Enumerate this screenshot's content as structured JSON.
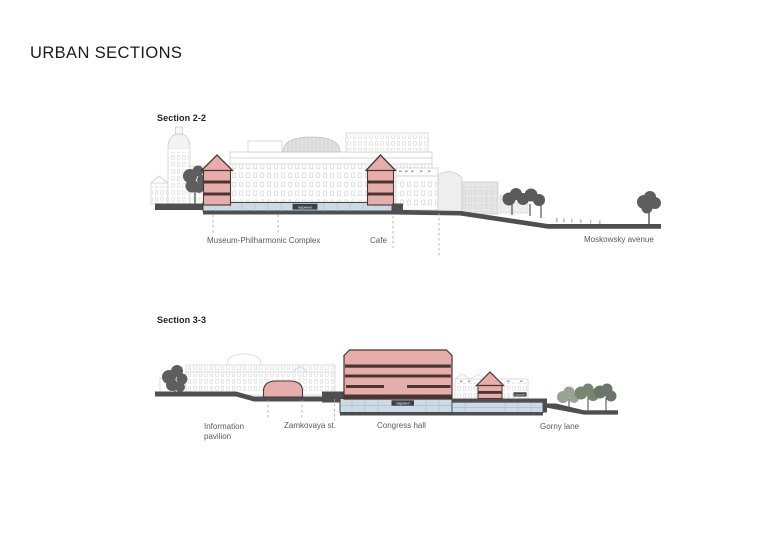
{
  "page": {
    "title": "URBAN SECTIONS"
  },
  "colors": {
    "section_fill": "#e6aeaa",
    "section_outline": "#4a3533",
    "parking_fill": "#ccdae5",
    "ground": "#4f4f4f",
    "context_line": "#c9c9c9",
    "tree_dark": "#5e5e5e",
    "tree_green": "#8f9a88",
    "annotation_text": "#5a5a5a"
  },
  "sections": [
    {
      "label": "Section 2-2",
      "parking_label": "паркинг",
      "annotations": [
        "Museum-Philharmonic Complex",
        "Cafe",
        "Moskowsky avenue"
      ]
    },
    {
      "label": "Section 3-3",
      "parking_label": "паркинг",
      "annotations": [
        "Information\npavilion",
        "Zamkovaya st.",
        "Congress hall",
        "Gorny lane"
      ]
    }
  ]
}
